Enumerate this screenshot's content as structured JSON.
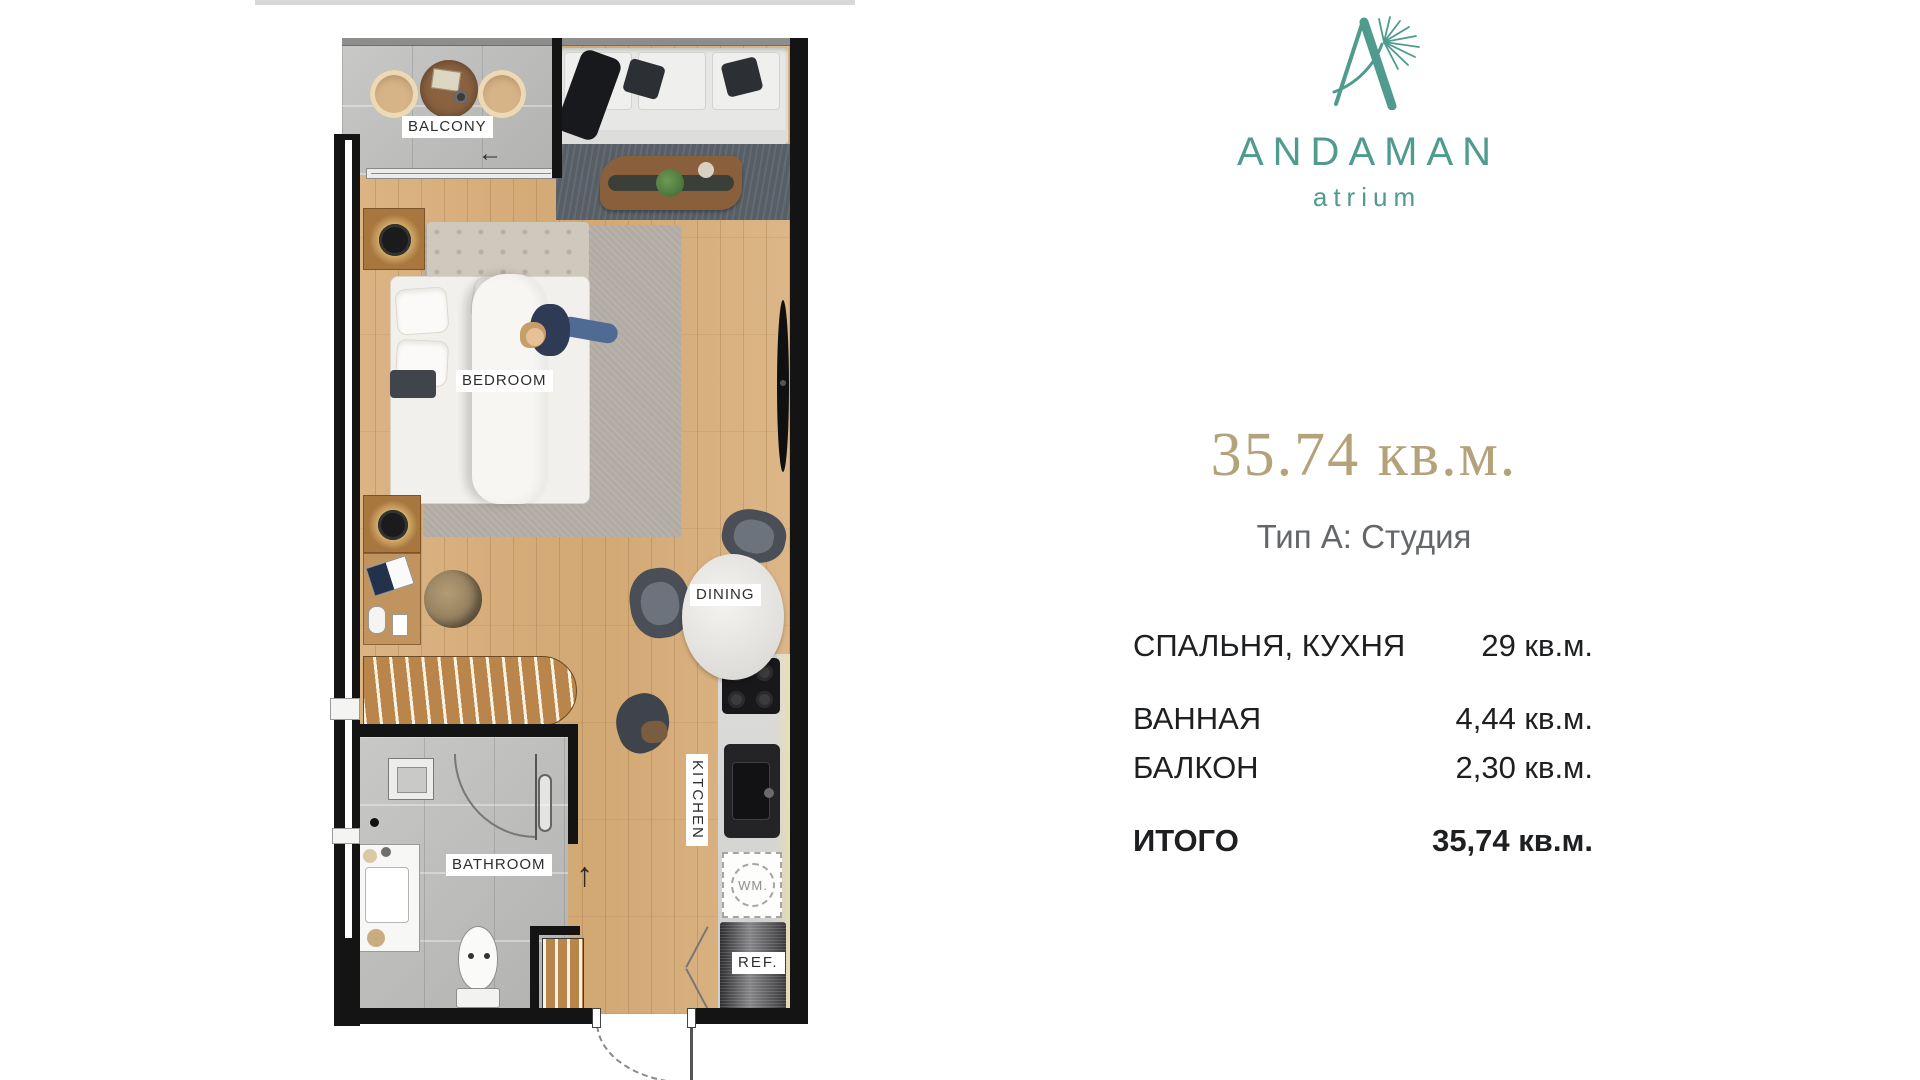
{
  "logo": {
    "name": "ANDAMAN",
    "subtitle": "atrium",
    "color": "#4F9B8E"
  },
  "unit": {
    "area_headline": "35.74 кв.м.",
    "type_line": "Тип А: Студия",
    "headline_color": "#B3A27A",
    "rows": [
      {
        "label": "СПАЛЬНЯ, КУХНЯ",
        "value": "29 кв.м."
      },
      {
        "label": "ВАННАЯ",
        "value": "4,44 кв.м."
      },
      {
        "label": "БАЛКОН",
        "value": "2,30 кв.м."
      },
      {
        "label": "ИТОГО",
        "value": "35,74 кв.м."
      }
    ]
  },
  "plan": {
    "labels": {
      "balcony": "BALCONY",
      "bedroom": "BEDROOM",
      "dining": "DINING",
      "kitchen": "KITCHEN",
      "bathroom": "BATHROOM",
      "fridge": "REF.",
      "washer": "WM."
    },
    "arrows": {
      "balcony_door": "←",
      "entry": "↑"
    }
  }
}
